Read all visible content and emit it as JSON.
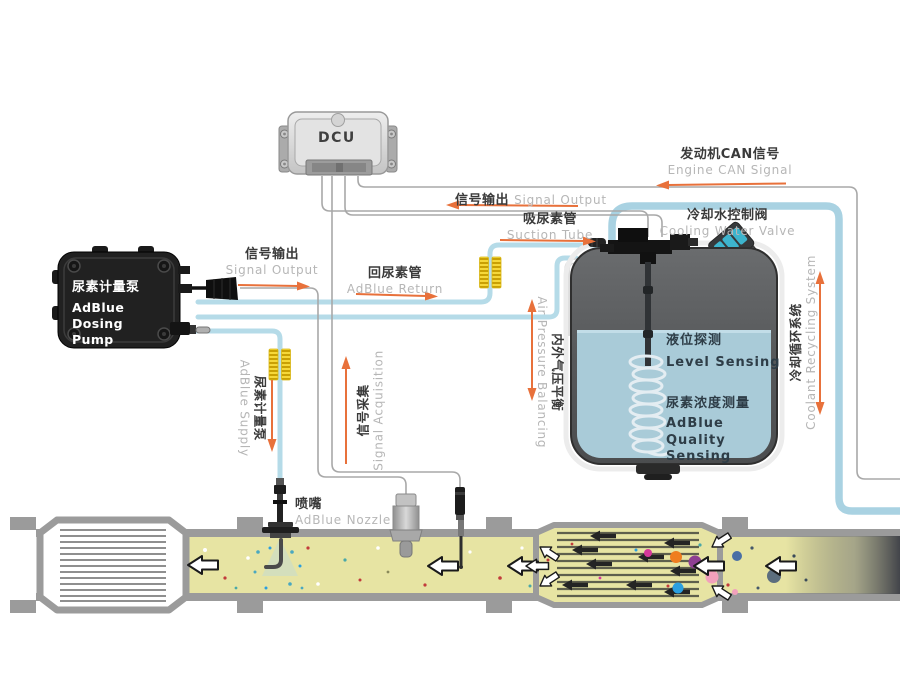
{
  "components": {
    "dcu": {
      "label": "DCU"
    },
    "pump": {
      "name_zh": "尿素计量泵",
      "name_en_line1": "AdBlue Dosing",
      "name_en_line2": "Pump"
    },
    "tank": {
      "level_zh": "液位探测",
      "level_en": "Level Sensing",
      "quality_zh": "尿素浓度测量",
      "quality_en_line1": "AdBlue Quality",
      "quality_en_line2": "Sensing"
    }
  },
  "labels": {
    "engine_can": {
      "zh": "发动机CAN信号",
      "en": "Engine CAN Signal"
    },
    "signal_output_top": {
      "zh": "信号输出",
      "en": "Signal Output"
    },
    "suction_tube": {
      "zh": "吸尿素管",
      "en": "Suction Tube"
    },
    "cooling_water_valve": {
      "zh": "冷却水控制阀",
      "en": "Cooling Water Valve"
    },
    "signal_output_pump": {
      "zh": "信号输出",
      "en": "Signal Output"
    },
    "adblue_return": {
      "zh": "回尿素管",
      "en": "AdBlue Return"
    },
    "adblue_supply": {
      "zh": "尿素计量泵",
      "en": "AdBlue Supply"
    },
    "signal_acquisition": {
      "zh": "信号采集",
      "en": "Signal Acquisition"
    },
    "air_pressure_balancing": {
      "zh": "内外气压平衡",
      "en": "Air Pressure Balancing"
    },
    "coolant_recycling": {
      "zh": "冷却循环系统",
      "en": "Coolant Recycling System"
    },
    "adblue_nozzle": {
      "zh": "喷嘴",
      "en": "AdBlue Nozzle"
    }
  },
  "colors": {
    "tube_blue": "#b5dbe8",
    "coolant_blue": "#a9d2e2",
    "wire_gray": "#a8a8a8",
    "arrow_orange": "#e8713b",
    "exhaust_yellow": "#e7e4a3",
    "pipe_gray": "#9b9b9b",
    "tank_liquid": "#a9cbd8",
    "heater_yellow": "#f6d83a",
    "label_zh": "#3a3a3a",
    "label_en": "#b6b6b6"
  }
}
